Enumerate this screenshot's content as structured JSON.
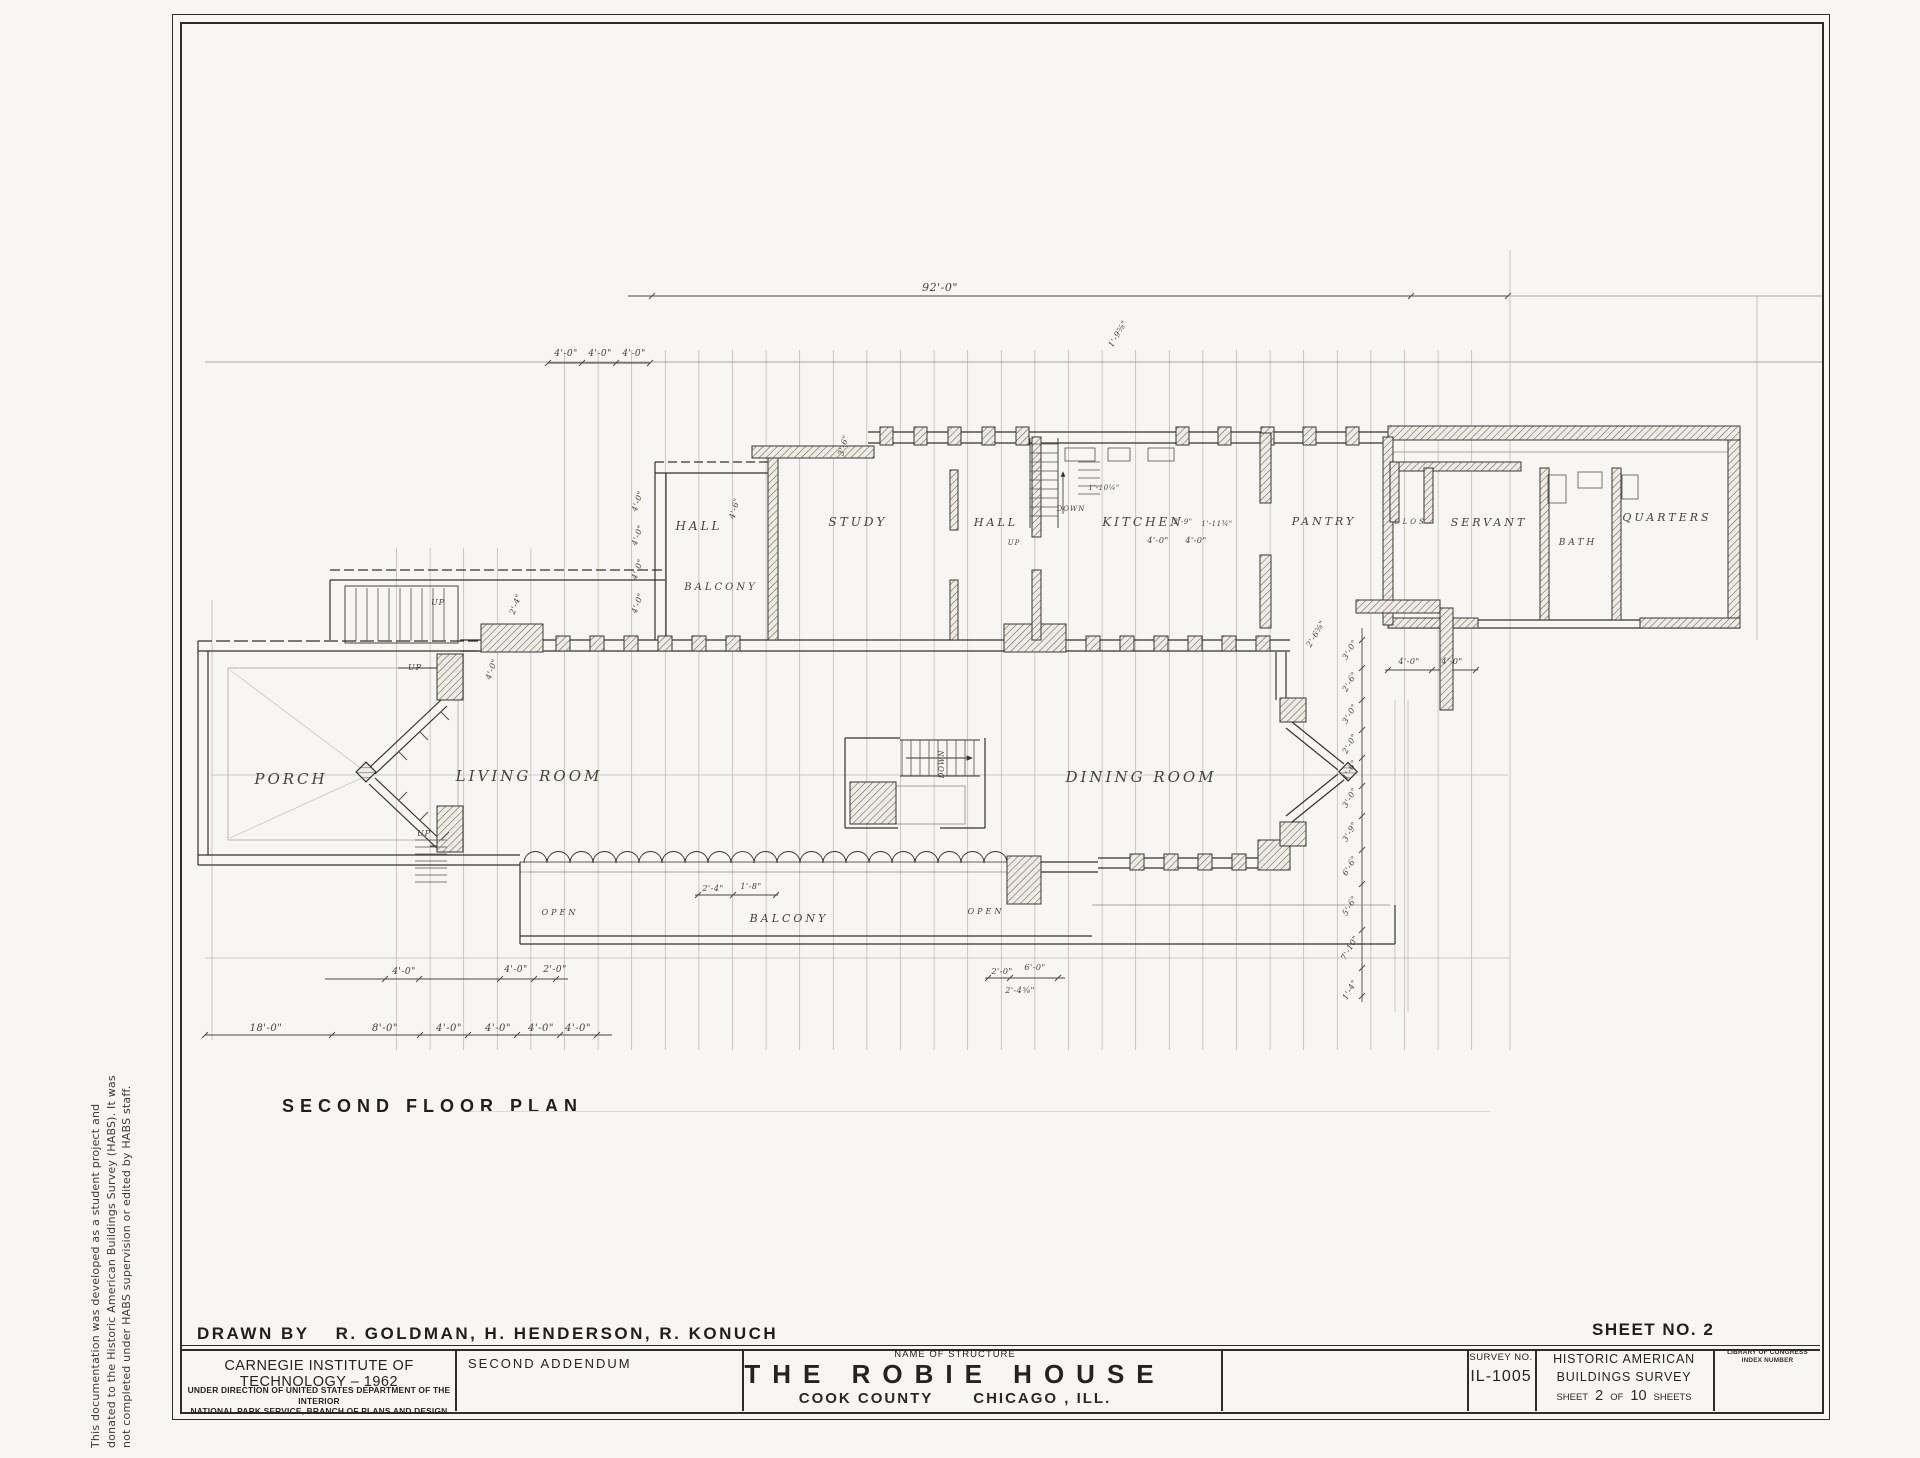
{
  "sheet": {
    "side_note_lines": [
      "This documentation was developed as a student project and",
      "donated to the Historic American Buildings Survey (HABS).  It was",
      "not completed under HABS supervision or edited by HABS staff."
    ],
    "plan_title": "SECOND FLOOR PLAN",
    "drawn_by_label": "DRAWN BY",
    "drawn_by_names": "R. GOLDMAN,   H. HENDERSON,  R. KONUCH",
    "sheet_no": "SHEET NO. 2"
  },
  "title_block": {
    "org": "CARNEGIE INSTITUTE OF TECHNOLOGY – 1962",
    "direction_line1": "UNDER DIRECTION OF UNITED STATES DEPARTMENT OF THE INTERIOR",
    "direction_line2": "NATIONAL PARK SERVICE, BRANCH OF PLANS AND DESIGN",
    "addendum": "SECOND ADDENDUM",
    "name_of_structure_label": "NAME OF STRUCTURE",
    "structure_name": "THE ROBIE HOUSE",
    "county": "COOK COUNTY",
    "city": "CHICAGO , ILL.",
    "survey_label": "SURVEY NO.",
    "survey_no": "IL-1005",
    "habs_line1": "HISTORIC AMERICAN",
    "habs_line2": "BUILDINGS SURVEY",
    "sheet_word": "SHEET",
    "sheet_num": "2",
    "of_word": "OF",
    "sheet_total": "10",
    "sheets_word": "SHEETS",
    "loc_line1": "LIBRARY OF CONGRESS",
    "loc_line2": "INDEX NUMBER"
  },
  "plan": {
    "room_labels": [
      {
        "text": "PORCH",
        "x": 291,
        "y": 784,
        "size": 15
      },
      {
        "text": "LIVING ROOM",
        "x": 529,
        "y": 781,
        "size": 15
      },
      {
        "text": "DINING ROOM",
        "x": 1141,
        "y": 782,
        "size": 15
      },
      {
        "text": "HALL",
        "x": 699,
        "y": 530,
        "size": 12
      },
      {
        "text": "STUDY",
        "x": 858,
        "y": 526,
        "size": 12
      },
      {
        "text": "HALL",
        "x": 996,
        "y": 526,
        "size": 11
      },
      {
        "text": "KITCHEN",
        "x": 1143,
        "y": 526,
        "size": 12
      },
      {
        "text": "PANTRY",
        "x": 1324,
        "y": 525,
        "size": 11
      },
      {
        "text": "CLOS.",
        "x": 1413,
        "y": 524,
        "size": 7
      },
      {
        "text": "SERVANT",
        "x": 1489,
        "y": 526,
        "size": 11
      },
      {
        "text": "BATH",
        "x": 1578,
        "y": 545,
        "size": 9
      },
      {
        "text": "QUARTERS",
        "x": 1667,
        "y": 521,
        "size": 11
      },
      {
        "text": "BALCONY",
        "x": 721,
        "y": 590,
        "size": 10
      },
      {
        "text": "BALCONY",
        "x": 789,
        "y": 922,
        "size": 11
      },
      {
        "text": "OPEN",
        "x": 560,
        "y": 915,
        "size": 8
      },
      {
        "text": "OPEN",
        "x": 986,
        "y": 914,
        "size": 8
      }
    ],
    "stair_labels": [
      {
        "text": "UP",
        "x": 438,
        "y": 605,
        "rot": 0,
        "size": 8
      },
      {
        "text": "UP",
        "x": 415,
        "y": 670,
        "rot": 0,
        "size": 8
      },
      {
        "text": "UP",
        "x": 424,
        "y": 836,
        "rot": 0,
        "size": 8
      },
      {
        "text": "UP",
        "x": 1014,
        "y": 545,
        "rot": 0,
        "size": 7
      },
      {
        "text": "DOWN",
        "x": 1071,
        "y": 511,
        "rot": 0,
        "size": 7
      },
      {
        "text": "DOWN",
        "x": 944,
        "y": 764,
        "rot": -90,
        "size": 7
      }
    ],
    "dim_labels": [
      {
        "text": "92'-0\"",
        "x": 940,
        "y": 291,
        "rot": 0,
        "size": 11
      },
      {
        "text": "4'-0\"",
        "x": 566,
        "y": 356,
        "rot": 0,
        "size": 9
      },
      {
        "text": "4'-0\"",
        "x": 600,
        "y": 356,
        "rot": 0,
        "size": 9
      },
      {
        "text": "4'-0\"",
        "x": 634,
        "y": 356,
        "rot": 0,
        "size": 9
      },
      {
        "text": "18'-0\"",
        "x": 266,
        "y": 1031,
        "rot": 0,
        "size": 10
      },
      {
        "text": "8'-0\"",
        "x": 385,
        "y": 1031,
        "rot": 0,
        "size": 10
      },
      {
        "text": "4'-0\"",
        "x": 449,
        "y": 1031,
        "rot": 0,
        "size": 10
      },
      {
        "text": "4'-0\"",
        "x": 498,
        "y": 1031,
        "rot": 0,
        "size": 10
      },
      {
        "text": "4'-0\"",
        "x": 541,
        "y": 1031,
        "rot": 0,
        "size": 10
      },
      {
        "text": "4'-0\"",
        "x": 578,
        "y": 1031,
        "rot": 0,
        "size": 10
      },
      {
        "text": "4'-0\"",
        "x": 404,
        "y": 974,
        "rot": 0,
        "size": 9
      },
      {
        "text": "4'-0\"",
        "x": 516,
        "y": 972,
        "rot": 0,
        "size": 9
      },
      {
        "text": "2'-0\"",
        "x": 555,
        "y": 972,
        "rot": 0,
        "size": 9
      },
      {
        "text": "2'-4\"",
        "x": 713,
        "y": 891,
        "rot": 0,
        "size": 8
      },
      {
        "text": "1'-8\"",
        "x": 751,
        "y": 889,
        "rot": 0,
        "size": 8
      },
      {
        "text": "2'-0\"",
        "x": 1002,
        "y": 974,
        "rot": 0,
        "size": 8
      },
      {
        "text": "6'-0\"",
        "x": 1035,
        "y": 970,
        "rot": 0,
        "size": 8
      },
      {
        "text": "2'-4⅝\"",
        "x": 1020,
        "y": 993,
        "rot": 0,
        "size": 8
      },
      {
        "text": "4'-0\"",
        "x": 1409,
        "y": 664,
        "rot": 0,
        "size": 8
      },
      {
        "text": "4'-0\"",
        "x": 1452,
        "y": 664,
        "rot": 0,
        "size": 8
      },
      {
        "text": "4'-0\"",
        "x": 1158,
        "y": 543,
        "rot": 0,
        "size": 8
      },
      {
        "text": "4'-0\"",
        "x": 1196,
        "y": 543,
        "rot": 0,
        "size": 8
      },
      {
        "text": "2'-9\"",
        "x": 1183,
        "y": 524,
        "rot": 0,
        "size": 7
      },
      {
        "text": "1'-11¾\"",
        "x": 1217,
        "y": 526,
        "rot": 0,
        "size": 7
      },
      {
        "text": "1'-10¼\"",
        "x": 1104,
        "y": 490,
        "rot": 0,
        "size": 7
      },
      {
        "text": "4'-0\"",
        "x": 640,
        "y": 502,
        "rot": -70,
        "size": 8
      },
      {
        "text": "4'-0\"",
        "x": 640,
        "y": 536,
        "rot": -70,
        "size": 8
      },
      {
        "text": "4'-0\"",
        "x": 640,
        "y": 570,
        "rot": -70,
        "size": 8
      },
      {
        "text": "4'-0\"",
        "x": 640,
        "y": 604,
        "rot": -70,
        "size": 8
      },
      {
        "text": "2'-4\"",
        "x": 518,
        "y": 605,
        "rot": -70,
        "size": 8
      },
      {
        "text": "4'-0\"",
        "x": 494,
        "y": 670,
        "rot": -70,
        "size": 8
      },
      {
        "text": "4'-6\"",
        "x": 737,
        "y": 509,
        "rot": -75,
        "size": 8
      },
      {
        "text": "3'-6\"",
        "x": 846,
        "y": 446,
        "rot": -75,
        "size": 8
      },
      {
        "text": "1'-9⅝\"",
        "x": 1120,
        "y": 335,
        "rot": -60,
        "size": 8
      },
      {
        "text": "2'-6⅝\"",
        "x": 1318,
        "y": 635,
        "rot": -60,
        "size": 8
      },
      {
        "text": "3'-0\"",
        "x": 1352,
        "y": 651,
        "rot": -60,
        "size": 8
      },
      {
        "text": "2'-6\"",
        "x": 1352,
        "y": 683,
        "rot": -60,
        "size": 8
      },
      {
        "text": "3'-0\"",
        "x": 1352,
        "y": 715,
        "rot": -60,
        "size": 8
      },
      {
        "text": "2'-0\"",
        "x": 1352,
        "y": 745,
        "rot": -60,
        "size": 8
      },
      {
        "text": "1'-6\"",
        "x": 1352,
        "y": 771,
        "rot": -60,
        "size": 8
      },
      {
        "text": "3'-0\"",
        "x": 1352,
        "y": 799,
        "rot": -60,
        "size": 8
      },
      {
        "text": "3'-9\"",
        "x": 1352,
        "y": 833,
        "rot": -60,
        "size": 8
      },
      {
        "text": "6'-6\"",
        "x": 1352,
        "y": 867,
        "rot": -60,
        "size": 8
      },
      {
        "text": "5'-6\"",
        "x": 1352,
        "y": 907,
        "rot": -60,
        "size": 8
      },
      {
        "text": "7'-10\"",
        "x": 1352,
        "y": 949,
        "rot": -60,
        "size": 8
      },
      {
        "text": "1'-4\"",
        "x": 1352,
        "y": 991,
        "rot": -60,
        "size": 8
      }
    ]
  }
}
